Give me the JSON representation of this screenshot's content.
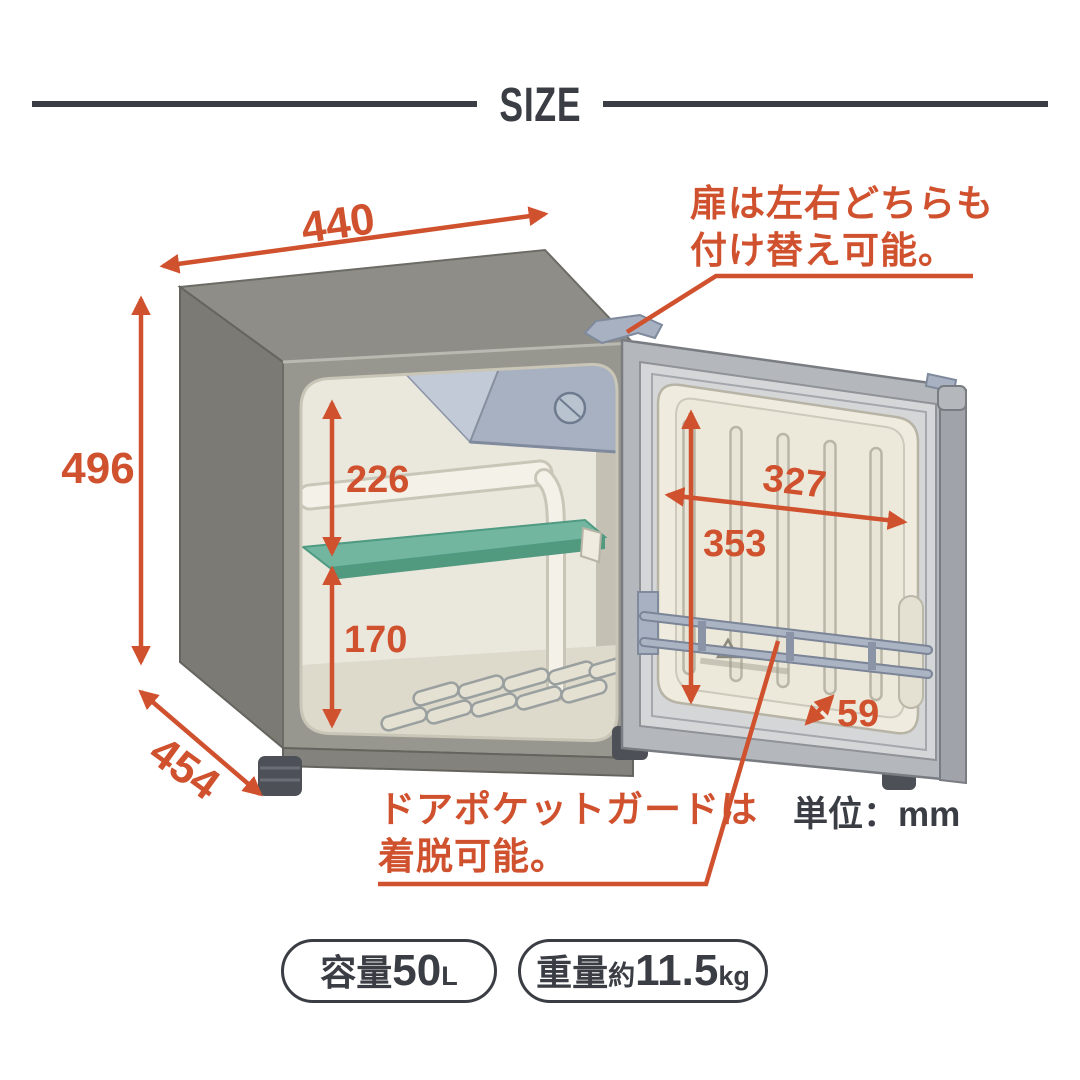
{
  "title": "SIZE",
  "unit_label": "単位：mm",
  "dimensions": {
    "width": "440",
    "height": "496",
    "depth": "454",
    "interior_upper_height": "226",
    "interior_lower_height": "170",
    "door_inner_width": "327",
    "door_inner_height": "353",
    "door_pocket_depth": "59"
  },
  "annotations": {
    "door_reversible_line1": "扉は左右どちらも",
    "door_reversible_line2": "付け替え可能。",
    "pocket_guard_line1": "ドアポケットガードは",
    "pocket_guard_line2": "着脱可能。"
  },
  "badges": {
    "capacity": {
      "label": "容量",
      "value": "50",
      "unit": "L"
    },
    "weight": {
      "label": "重量",
      "approx": "約",
      "value": "11.5",
      "unit": "kg"
    }
  },
  "colors": {
    "accent": "#d0512e",
    "ink": "#3a3d43",
    "cabinet_gray": "#8e8d87",
    "interior_cream": "#eae7dd",
    "shelf_teal": "#72b6a0",
    "freezer_blue_gray": "#a7b1c1"
  }
}
